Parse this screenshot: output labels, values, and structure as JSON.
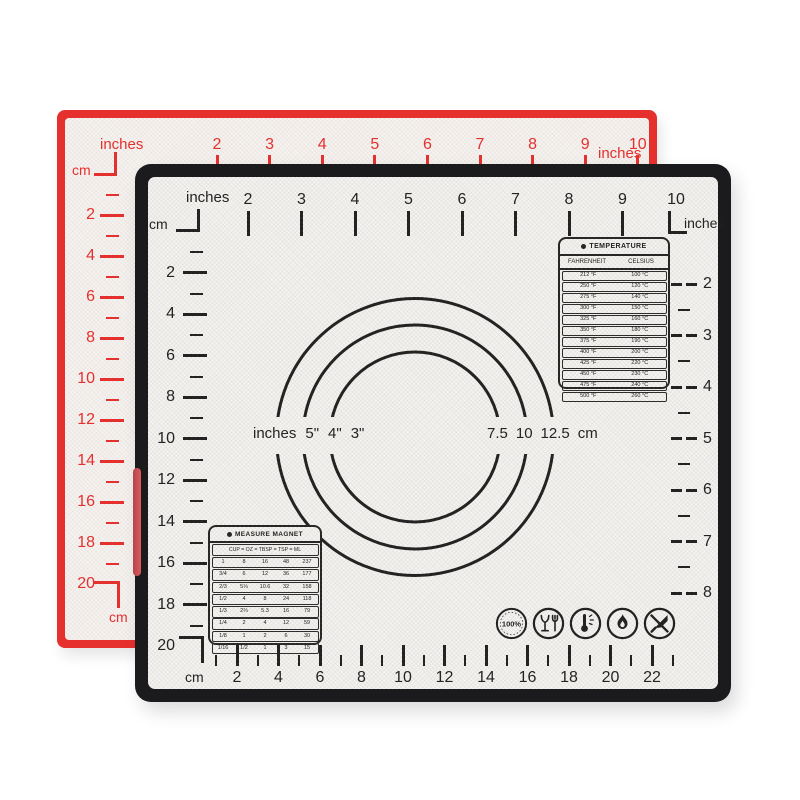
{
  "colors": {
    "red": "#e6302e",
    "black": "#1b1b1d",
    "surface": "#f4f3f0",
    "ink": "#202020"
  },
  "red_mat": {
    "top_ruler": {
      "side_label": "inches",
      "corner_unit": "cm",
      "numbers": [
        "2",
        "3",
        "4",
        "5",
        "6",
        "7",
        "8",
        "9",
        "10"
      ],
      "right_end_label": "inches"
    },
    "left_ruler": {
      "numbers": [
        "2",
        "4",
        "6",
        "8",
        "10",
        "12",
        "14",
        "16",
        "18"
      ],
      "terminal_number": "20",
      "bottom_unit": "cm"
    }
  },
  "black_mat": {
    "top_ruler": {
      "side_label": "inches",
      "corner_unit": "cm",
      "numbers": [
        "2",
        "3",
        "4",
        "5",
        "6",
        "7",
        "8",
        "9",
        "10"
      ],
      "right_corner_label": "inches"
    },
    "left_ruler": {
      "numbers": [
        "2",
        "4",
        "6",
        "8",
        "10",
        "12",
        "14",
        "16",
        "18"
      ],
      "terminal_number": "20"
    },
    "bottom_ruler": {
      "unit": "cm",
      "numbers": [
        "2",
        "4",
        "6",
        "8",
        "10",
        "12",
        "14",
        "16",
        "18",
        "20",
        "22"
      ]
    },
    "right_ruler": {
      "numbers": [
        "2",
        "3",
        "4",
        "5",
        "6",
        "7",
        "8"
      ]
    },
    "circles": {
      "left_unit": "inches",
      "inch_labels": [
        "5\"",
        "4\"",
        "3\""
      ],
      "cm_labels": [
        "7.5",
        "10",
        "12.5"
      ],
      "right_unit": "cm"
    },
    "temperature_table": {
      "title": "TEMPERATURE",
      "columns": [
        "FAHRENHEIT",
        "CELSIUS"
      ],
      "rows": [
        [
          "212 °F",
          "100 °C"
        ],
        [
          "250 °F",
          "120 °C"
        ],
        [
          "275 °F",
          "140 °C"
        ],
        [
          "300 °F",
          "150 °C"
        ],
        [
          "325 °F",
          "160 °C"
        ],
        [
          "350 °F",
          "180 °C"
        ],
        [
          "375 °F",
          "190 °C"
        ],
        [
          "400 °F",
          "200 °C"
        ],
        [
          "425 °F",
          "220 °C"
        ],
        [
          "450 °F",
          "230 °C"
        ],
        [
          "475 °F",
          "240 °C"
        ],
        [
          "500 °F",
          "260 °C"
        ]
      ]
    },
    "measure_table": {
      "title": "MEASURE MAGNET",
      "header": "CUP = OZ = TBSP = TSP = ML",
      "rows": [
        [
          "1",
          "8",
          "16",
          "48",
          "237"
        ],
        [
          "3/4",
          "6",
          "12",
          "36",
          "177"
        ],
        [
          "2/3",
          "5⅓",
          "10.6",
          "32",
          "158"
        ],
        [
          "1/2",
          "4",
          "8",
          "24",
          "118"
        ],
        [
          "1/3",
          "2⅔",
          "5.3",
          "16",
          "79"
        ],
        [
          "1/4",
          "2",
          "4",
          "12",
          "59"
        ],
        [
          "1/8",
          "1",
          "2",
          "6",
          "30"
        ],
        [
          "1/16",
          "1/2",
          "1",
          "3",
          "15"
        ]
      ]
    },
    "icons": [
      {
        "name": "platinum-silicone-100-icon",
        "text": "100%"
      },
      {
        "name": "food-safe-glass-fork-icon"
      },
      {
        "name": "heat-resistant-thermometer-icon"
      },
      {
        "name": "open-flame-icon"
      },
      {
        "name": "no-knife-cut-icon"
      }
    ]
  }
}
